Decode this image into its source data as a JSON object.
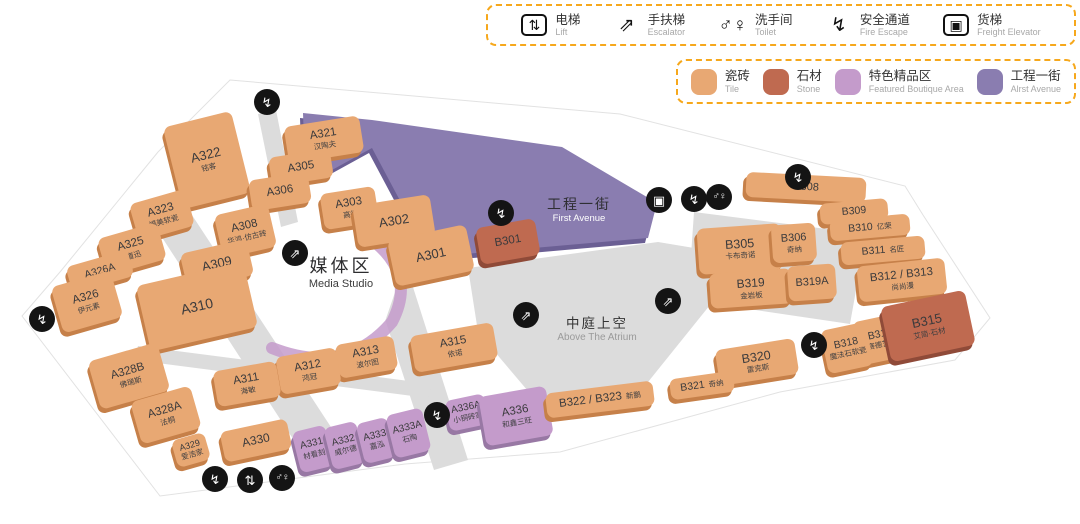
{
  "palette": {
    "tile": "#E8A873",
    "tile_side": "#C68049",
    "stone": "#BF6A50",
    "stone_side": "#8F4A38",
    "featured": "#C49BCB",
    "featured_side": "#9878A4",
    "avenue": "#8A7DB0",
    "avenue_side": "#6B5F94",
    "road": "#DCDCDC",
    "icon_bg": "#141414",
    "legend_border": "#F6A81C"
  },
  "icon_glyphs": {
    "lift": "⇅",
    "escalator": "⇗",
    "toilet": "♂♀",
    "fire-escape": "↯",
    "freight-elevator": "▣"
  },
  "legend_facilities": {
    "items": [
      {
        "key": "lift",
        "zh": "电梯",
        "en": "Lift",
        "boxed": true
      },
      {
        "key": "escalator",
        "zh": "手扶梯",
        "en": "Escalator",
        "boxed": false
      },
      {
        "key": "toilet",
        "zh": "洗手间",
        "en": "Toilet",
        "boxed": false
      },
      {
        "key": "fire-escape",
        "zh": "安全通道",
        "en": "Fire Escape",
        "boxed": false
      },
      {
        "key": "freight-elevator",
        "zh": "货梯",
        "en": "Freight Elevator",
        "boxed": true
      }
    ]
  },
  "legend_categories": {
    "items": [
      {
        "key": "tile",
        "zh": "瓷砖",
        "en": "Tile",
        "color": "#E8A873"
      },
      {
        "key": "stone",
        "zh": "石材",
        "en": "Stone",
        "color": "#BF6A50"
      },
      {
        "key": "featured",
        "zh": "特色精品区",
        "en": "Featured Boutique Area",
        "color": "#C49BCB"
      },
      {
        "key": "avenue",
        "zh": "工程一街",
        "en": "Alrst Avenue",
        "color": "#8A7DB0"
      }
    ]
  },
  "map": {
    "area_labels": [
      {
        "key": "avenue",
        "zh": "工程一街",
        "en": "First Avenue",
        "x": 579,
        "y": 196
      },
      {
        "key": "media-studio",
        "zh": "媒体区",
        "en": "Media Studio",
        "x": 341,
        "y": 256
      },
      {
        "key": "atrium",
        "zh": "中庭上空",
        "en": "Above The Atrium",
        "x": 597,
        "y": 316
      }
    ],
    "units": [
      {
        "id": "A322",
        "sub": "铭客",
        "type": "tile",
        "x": 172,
        "y": 118,
        "w": 70,
        "h": 84,
        "rot": -14,
        "fs": 13
      },
      {
        "id": "A323",
        "sub": "福美软瓷",
        "type": "tile",
        "x": 133,
        "y": 196,
        "w": 58,
        "h": 38,
        "rot": -16
      },
      {
        "id": "A325",
        "sub": "道迅",
        "type": "tile",
        "x": 101,
        "y": 230,
        "w": 62,
        "h": 38,
        "rot": -16
      },
      {
        "id": "A326A",
        "type": "tile",
        "x": 68,
        "y": 258,
        "w": 64,
        "h": 27,
        "rot": -16,
        "fs": 10.5
      },
      {
        "id": "A326",
        "sub": "伊元素",
        "type": "tile",
        "x": 56,
        "y": 278,
        "w": 62,
        "h": 48,
        "rot": -16
      },
      {
        "id": "A321",
        "sub": "汉陶夫",
        "type": "tile",
        "x": 286,
        "y": 121,
        "w": 76,
        "h": 37,
        "rot": -9
      },
      {
        "id": "A305",
        "type": "tile",
        "x": 270,
        "y": 153,
        "w": 62,
        "h": 29,
        "rot": -9
      },
      {
        "id": "A306",
        "type": "tile",
        "x": 250,
        "y": 176,
        "w": 60,
        "h": 31,
        "rot": -9
      },
      {
        "id": "A303",
        "sub": "高德",
        "type": "tile",
        "x": 322,
        "y": 190,
        "w": 55,
        "h": 36,
        "rot": -9
      },
      {
        "id": "A302",
        "type": "tile",
        "x": 355,
        "y": 200,
        "w": 78,
        "h": 42,
        "rot": -9,
        "fs": 13
      },
      {
        "id": "A301",
        "type": "tile",
        "x": 391,
        "y": 232,
        "w": 80,
        "h": 47,
        "rot": -12,
        "fs": 13
      },
      {
        "id": "A308",
        "sub": "华鸿·仿古砖",
        "type": "tile",
        "x": 218,
        "y": 209,
        "w": 55,
        "h": 44,
        "rot": -13
      },
      {
        "id": "A309",
        "type": "tile",
        "x": 183,
        "y": 246,
        "w": 68,
        "h": 37,
        "rot": -13,
        "fs": 13
      },
      {
        "id": "A310",
        "type": "tile",
        "x": 142,
        "y": 273,
        "w": 110,
        "h": 67,
        "rot": -13,
        "fs": 14
      },
      {
        "id": "A315",
        "sub": "依诺",
        "type": "tile",
        "x": 412,
        "y": 329,
        "w": 84,
        "h": 37,
        "rot": -10
      },
      {
        "id": "A313",
        "sub": "波尔图",
        "type": "tile",
        "x": 337,
        "y": 340,
        "w": 59,
        "h": 34,
        "rot": -10
      },
      {
        "id": "A312",
        "sub": "鸿冠",
        "type": "tile",
        "x": 278,
        "y": 352,
        "w": 61,
        "h": 38,
        "rot": -10
      },
      {
        "id": "A311",
        "sub": "海敏",
        "type": "tile",
        "x": 215,
        "y": 366,
        "w": 64,
        "h": 36,
        "rot": -10
      },
      {
        "id": "A328B",
        "sub": "佛瑞斯",
        "type": "tile",
        "x": 93,
        "y": 351,
        "w": 72,
        "h": 50,
        "rot": -16
      },
      {
        "id": "A328A",
        "sub": "法桐",
        "type": "tile",
        "x": 135,
        "y": 393,
        "w": 62,
        "h": 44,
        "rot": -16
      },
      {
        "id": "A329",
        "sub": "爱浩家",
        "type": "tile",
        "x": 174,
        "y": 436,
        "w": 34,
        "h": 28,
        "rot": -16,
        "fs": 9
      },
      {
        "id": "A330",
        "type": "tile",
        "x": 222,
        "y": 425,
        "w": 68,
        "h": 31,
        "rot": -12,
        "fs": 12
      },
      {
        "id": "A331",
        "sub": "材看刻",
        "type": "featured",
        "x": 296,
        "y": 428,
        "w": 34,
        "h": 42,
        "rot": -14,
        "fs": 10
      },
      {
        "id": "A332",
        "sub": "威尔德",
        "type": "featured",
        "x": 328,
        "y": 424,
        "w": 33,
        "h": 43,
        "rot": -14,
        "fs": 10
      },
      {
        "id": "A333",
        "sub": "嘉泓",
        "type": "featured",
        "x": 360,
        "y": 420,
        "w": 32,
        "h": 41,
        "rot": -14,
        "fs": 10
      },
      {
        "id": "A333A",
        "sub": "石陶",
        "type": "featured",
        "x": 390,
        "y": 411,
        "w": 37,
        "h": 44,
        "rot": -14,
        "fs": 10
      },
      {
        "id": "A336A",
        "sub": "小铜砖家",
        "type": "featured",
        "x": 447,
        "y": 397,
        "w": 40,
        "h": 31,
        "rot": -12,
        "fs": 10
      },
      {
        "id": "A336",
        "sub": "和鑫三旺",
        "type": "featured",
        "x": 482,
        "y": 391,
        "w": 68,
        "h": 50,
        "rot": -10
      },
      {
        "id": "B301",
        "type": "stone",
        "x": 478,
        "y": 223,
        "w": 60,
        "h": 37,
        "rot": -10
      },
      {
        "id": "B308",
        "type": "tile",
        "x": 746,
        "y": 175,
        "w": 120,
        "h": 25,
        "rot": 3,
        "fs": 11
      },
      {
        "id": "B309",
        "type": "tile",
        "x": 820,
        "y": 201,
        "w": 68,
        "h": 21,
        "rot": -5,
        "fs": 10.5
      },
      {
        "id": "B310",
        "sub": "亿荣",
        "subPos": "right",
        "type": "tile",
        "x": 830,
        "y": 217,
        "w": 80,
        "h": 21,
        "rot": -5,
        "fs": 10.5
      },
      {
        "id": "B311",
        "sub": "名匠",
        "subPos": "right",
        "type": "tile",
        "x": 841,
        "y": 239,
        "w": 84,
        "h": 23,
        "rot": -5,
        "fs": 10.5
      },
      {
        "id": "B312 / B313",
        "sub": "尚尚漫",
        "type": "tile",
        "x": 858,
        "y": 262,
        "w": 88,
        "h": 36,
        "rot": -6,
        "fs": 11.5
      },
      {
        "id": "B305",
        "sub": "卡布奇诺",
        "type": "tile",
        "x": 698,
        "y": 226,
        "w": 84,
        "h": 46,
        "rot": -4,
        "fs": 12.5
      },
      {
        "id": "B306",
        "sub": "奇纳",
        "type": "tile",
        "x": 772,
        "y": 224,
        "w": 44,
        "h": 38,
        "rot": -4,
        "fs": 11
      },
      {
        "id": "B319",
        "sub": "金岩板",
        "type": "tile",
        "x": 710,
        "y": 271,
        "w": 82,
        "h": 35,
        "rot": -4,
        "fs": 12
      },
      {
        "id": "B319A",
        "type": "tile",
        "x": 788,
        "y": 265,
        "w": 48,
        "h": 35,
        "rot": -4,
        "fs": 11
      },
      {
        "id": "B320",
        "sub": "雷克斯",
        "type": "tile",
        "x": 717,
        "y": 344,
        "w": 80,
        "h": 36,
        "rot": -9,
        "fs": 12.5
      },
      {
        "id": "B321",
        "sub": "奇纳",
        "subPos": "right",
        "type": "tile",
        "x": 670,
        "y": 375,
        "w": 64,
        "h": 21,
        "rot": -8,
        "fs": 10.5
      },
      {
        "id": "B322 / B323",
        "sub": "新鹏",
        "subPos": "right",
        "type": "tile",
        "x": 546,
        "y": 387,
        "w": 108,
        "h": 25,
        "rot": -7,
        "fs": 11.5
      },
      {
        "id": "B316",
        "sub": "赛德艺典",
        "type": "tile",
        "x": 856,
        "y": 317,
        "w": 50,
        "h": 44,
        "rot": -12,
        "fs": 10.5
      },
      {
        "id": "B318",
        "sub": "魔法石软瓷",
        "type": "tile",
        "x": 824,
        "y": 326,
        "w": 46,
        "h": 44,
        "rot": -12,
        "fs": 10.5
      },
      {
        "id": "B315",
        "sub": "艾简·石材",
        "type": "stone",
        "x": 885,
        "y": 298,
        "w": 86,
        "h": 56,
        "rot": -12,
        "fs": 13
      }
    ],
    "icons": [
      {
        "type": "fire-escape",
        "x": 267,
        "y": 102
      },
      {
        "type": "fire-escape",
        "x": 42,
        "y": 319
      },
      {
        "type": "escalator",
        "x": 295,
        "y": 253
      },
      {
        "type": "fire-escape",
        "x": 501,
        "y": 213
      },
      {
        "type": "freight-elevator",
        "x": 659,
        "y": 200
      },
      {
        "type": "fire-escape",
        "x": 694,
        "y": 199
      },
      {
        "type": "toilet",
        "x": 719,
        "y": 197
      },
      {
        "type": "fire-escape",
        "x": 798,
        "y": 177
      },
      {
        "type": "escalator",
        "x": 668,
        "y": 301
      },
      {
        "type": "escalator",
        "x": 526,
        "y": 315
      },
      {
        "type": "fire-escape",
        "x": 814,
        "y": 345
      },
      {
        "type": "fire-escape",
        "x": 437,
        "y": 415
      },
      {
        "type": "fire-escape",
        "x": 215,
        "y": 479
      },
      {
        "type": "lift",
        "x": 250,
        "y": 480
      },
      {
        "type": "toilet",
        "x": 282,
        "y": 478
      }
    ]
  }
}
